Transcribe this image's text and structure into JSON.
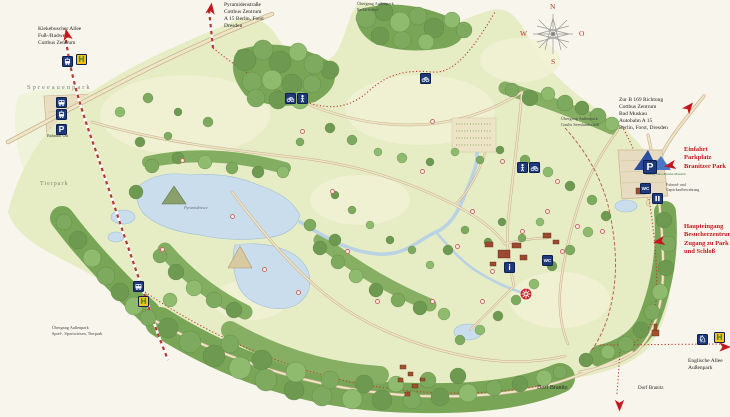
{
  "compass": {
    "north": "N",
    "east": "O",
    "south": "S",
    "west": "W"
  },
  "colors": {
    "annotation_red": "#c5161d",
    "icon_blue": "#1e3a7a",
    "icon_yellow": "#f2c41d",
    "route_red": "#c0392b",
    "water": "#cadded",
    "meadow": "#e6ecc4",
    "forest": "#79a556",
    "path_tan": "#efe5c9",
    "background": "#f8f6ec"
  },
  "labels": [
    {
      "id": "kiekebuscher-allee-label",
      "lines": [
        "Kiekebuscher Allee",
        "Fuß-/Radweg",
        "Cottbus Zentrum"
      ],
      "x": 38,
      "y": 26,
      "size": 5.5,
      "color": "#222222"
    },
    {
      "id": "pyramidenstrasse-label",
      "lines": [
        "Pyramidenstraße",
        "Cottbus Zentrum",
        "A 15 Berlin, Forst",
        "Dresden"
      ],
      "x": 224,
      "y": 2,
      "size": 5.5,
      "color": "#222222"
    },
    {
      "id": "uebergang-parkfriedhof-label",
      "lines": [
        "Übergang Außenpark",
        "Parkfriedhof"
      ],
      "x": 357,
      "y": 1,
      "size": 4.3,
      "color": "#444444"
    },
    {
      "id": "zur-b169-label",
      "lines": [
        "Zur B 169 Richtung",
        "Cottbus Zentrum",
        "Bad Muskau",
        "Autobahn A 15",
        "Berlin, Forst, Dresden"
      ],
      "x": 619,
      "y": 97,
      "size": 5.5,
      "color": "#222222"
    },
    {
      "id": "einfahrt-parkplatz-label",
      "lines": [
        "Einfahrt",
        "Parkplatz",
        "Branitzer Park"
      ],
      "x": 684,
      "y": 146,
      "size": 6.5,
      "color": "#c5161d",
      "bold": true
    },
    {
      "id": "uebergang-gaulis-label",
      "lines": [
        "Übergang Außenpark",
        "Gaulis Seenlandschaft"
      ],
      "x": 561,
      "y": 116,
      "size": 4.3,
      "color": "#444444"
    },
    {
      "id": "haupteingang-label",
      "lines": [
        "Haupteingang",
        "Besucherzentrum",
        "Zugang zu Park",
        "und Schloß"
      ],
      "x": 684,
      "y": 223,
      "size": 6.5,
      "color": "#c5161d",
      "bold": true
    },
    {
      "id": "spreeauenpark-label",
      "lines": [
        "Spreeauenpark"
      ],
      "x": 27,
      "y": 84,
      "size": 6.5,
      "color": "#76866b",
      "spacing": 2
    },
    {
      "id": "bahnhof-ost-label",
      "lines": [
        "Bahnhof Ost"
      ],
      "x": 47,
      "y": 133,
      "size": 4.2,
      "color": "#333333"
    },
    {
      "id": "tierpark-label",
      "lines": [
        "Tierpark"
      ],
      "x": 40,
      "y": 181,
      "size": 6,
      "color": "#76866b",
      "spacing": 1
    },
    {
      "id": "pyramidensee-label",
      "lines": [
        "Pyramidensee"
      ],
      "x": 184,
      "y": 205,
      "size": 4.2,
      "color": "#5f6e80",
      "italic": true
    },
    {
      "id": "uebergang-spielwiesen-label",
      "lines": [
        "Übergang Außenpark",
        "Spiel-, Sportwiesen, Tierpark"
      ],
      "x": 52,
      "y": 325,
      "size": 4.3,
      "color": "#444444"
    },
    {
      "id": "englische-allee-label",
      "lines": [
        "Englische Allee",
        "Außenpark"
      ],
      "x": 688,
      "y": 358,
      "size": 5.5,
      "color": "#222222"
    },
    {
      "id": "dorf-branitz-west-label",
      "lines": [
        "Dorf Branitz"
      ],
      "x": 537,
      "y": 385,
      "size": 6,
      "color": "#222222"
    },
    {
      "id": "dorf-branitz-east-label",
      "lines": [
        "Dorf Branitz"
      ],
      "x": 638,
      "y": 386,
      "size": 5,
      "color": "#222222"
    },
    {
      "id": "fahrrad-aufbewahrung-label",
      "lines": [
        "Fahrrad- und",
        "Gepäckaufbewahrung"
      ],
      "x": 666,
      "y": 183,
      "size": 3.8,
      "color": "#444444"
    },
    {
      "id": "stiftung-logo-label",
      "lines": [
        "Stiftung Fürst-Pückler-Museum"
      ],
      "x": 645,
      "y": 172,
      "size": 3.2,
      "color": "#3a6b35"
    }
  ],
  "icons": [
    {
      "id": "tram-stop-kiekebuscher-icon",
      "type": "tram",
      "x": 62,
      "y": 56
    },
    {
      "id": "haltestelle-kiekebuscher-icon",
      "type": "stop",
      "x": 76,
      "y": 54
    },
    {
      "id": "bus-spreeauenpark-icon",
      "type": "bus",
      "x": 56,
      "y": 97
    },
    {
      "id": "tram-spreeauenpark-icon",
      "type": "tram",
      "x": 56,
      "y": 109
    },
    {
      "id": "parking-spreeauenpark-icon",
      "type": "parking",
      "x": 56,
      "y": 124
    },
    {
      "id": "bike-route-north-icon",
      "type": "bike",
      "x": 285,
      "y": 93
    },
    {
      "id": "pedestrian-route-north-icon",
      "type": "person",
      "x": 297,
      "y": 93
    },
    {
      "id": "bike-route-northeast-icon",
      "type": "bike",
      "x": 420,
      "y": 73
    },
    {
      "id": "pedestrian-route-east-icon",
      "type": "person",
      "x": 517,
      "y": 162
    },
    {
      "id": "bike-route-east-icon",
      "type": "bike",
      "x": 529,
      "y": 162
    },
    {
      "id": "parking-branitz-icon",
      "type": "parking",
      "x": 643,
      "y": 160,
      "size": 14
    },
    {
      "id": "wc-visitor-icon",
      "type": "wc",
      "x": 640,
      "y": 183
    },
    {
      "id": "gate-visitor-icon",
      "type": "gate",
      "x": 652,
      "y": 193
    },
    {
      "id": "info-schloss-icon",
      "type": "info",
      "x": 504,
      "y": 262
    },
    {
      "id": "wc-schloss-icon",
      "type": "wc",
      "x": 542,
      "y": 255
    },
    {
      "id": "wheel-marker-icon",
      "type": "wheel",
      "x": 520,
      "y": 288
    },
    {
      "id": "bus-tierpark-icon",
      "type": "bus",
      "x": 133,
      "y": 281
    },
    {
      "id": "haltestelle-south-icon",
      "type": "stop",
      "x": 138,
      "y": 296
    },
    {
      "id": "riding-trail-icon",
      "type": "knight",
      "x": 697,
      "y": 334
    },
    {
      "id": "haltestelle-east-icon",
      "type": "stop",
      "x": 714,
      "y": 332
    }
  ],
  "arrows": [
    {
      "id": "arrow-kiekebuscher",
      "x": 61,
      "y": 28,
      "rot": -12
    },
    {
      "id": "arrow-pyramidenstrasse",
      "x": 204,
      "y": 2,
      "rot": 8
    },
    {
      "id": "arrow-b169",
      "x": 681,
      "y": 100,
      "rot": 40
    },
    {
      "id": "arrow-einfahrt",
      "x": 666,
      "y": 156,
      "rot": -100
    },
    {
      "id": "arrow-haupteingang",
      "x": 655,
      "y": 232,
      "rot": -100
    },
    {
      "id": "arrow-englische-allee",
      "x": 716,
      "y": 338,
      "rot": 90
    },
    {
      "id": "arrow-dorf-branitz",
      "x": 613,
      "y": 394,
      "rot": 180
    }
  ],
  "poi_markers": [
    {
      "x": 180,
      "y": 158
    },
    {
      "x": 230,
      "y": 214
    },
    {
      "x": 262,
      "y": 267
    },
    {
      "x": 296,
      "y": 290
    },
    {
      "x": 160,
      "y": 247
    },
    {
      "x": 345,
      "y": 249
    },
    {
      "x": 420,
      "y": 169
    },
    {
      "x": 455,
      "y": 244
    },
    {
      "x": 470,
      "y": 209
    },
    {
      "x": 490,
      "y": 269
    },
    {
      "x": 520,
      "y": 229
    },
    {
      "x": 545,
      "y": 209
    },
    {
      "x": 560,
      "y": 249
    },
    {
      "x": 575,
      "y": 224
    },
    {
      "x": 600,
      "y": 229
    },
    {
      "x": 480,
      "y": 299
    },
    {
      "x": 430,
      "y": 299
    },
    {
      "x": 375,
      "y": 299
    },
    {
      "x": 330,
      "y": 189
    },
    {
      "x": 300,
      "y": 129
    },
    {
      "x": 430,
      "y": 119
    },
    {
      "x": 500,
      "y": 159
    },
    {
      "x": 555,
      "y": 179
    }
  ]
}
